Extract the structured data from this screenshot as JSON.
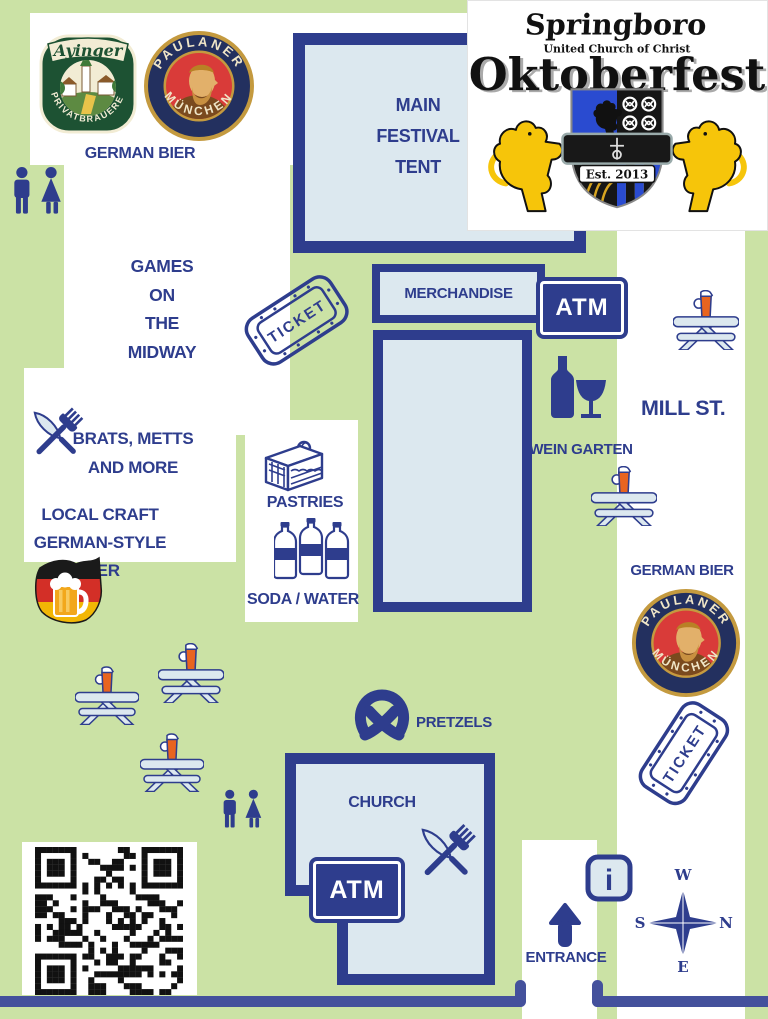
{
  "colors": {
    "navy": "#2e3d8d",
    "green": "#cbe2a5",
    "building_fill": "#dce8ef",
    "road": "#44519c",
    "beer_orange": "#e8641f",
    "lion_gold": "#f6c50a",
    "ayinger_green": "#1d5233",
    "ayinger_cream": "#f2ecd4",
    "paulaner_gold": "#c49a3f",
    "paulaner_navy": "#23305f",
    "paulaner_red": "#d93b39",
    "flag_black": "#1a1a1a",
    "flag_red": "#d32f27",
    "flag_gold": "#f2b705"
  },
  "crest": {
    "line1": "Springboro",
    "line2": "United Church of Christ",
    "line3": "Oktoberfest",
    "est": "Est. 2013"
  },
  "logos": {
    "ayinger": {
      "name": "Ayinger",
      "subtitle": "PRIVATBRAUEREI"
    },
    "paulaner": {
      "name": "PAULANER",
      "city": "MÜNCHEN"
    }
  },
  "labels": {
    "german_bier_top": "GERMAN BIER",
    "main_tent_lines": [
      "MAIN",
      "FESTIVAL",
      "TENT"
    ],
    "games_lines": [
      "GAMES",
      "ON",
      "THE",
      "MIDWAY"
    ],
    "merchandise": "MERCHANDISE",
    "atm": "ATM",
    "ticket": "TICKET",
    "mill_st": "MILL ST.",
    "wein_garten": "WEIN GARTEN",
    "brats_lines": [
      "BRATS, METTS",
      "AND MORE"
    ],
    "local_lines": [
      "LOCAL CRAFT",
      "GERMAN-STYLE BIER"
    ],
    "pastries": "PASTRIES",
    "soda_water": "SODA / WATER",
    "german_bier_right": "GERMAN BIER",
    "pretzels": "PRETZELS",
    "church": "CHURCH",
    "entrance": "ENTRANCE",
    "compass": {
      "top": "W",
      "right": "N",
      "left": "S",
      "bottom": "E"
    }
  },
  "qr_code": {
    "present": true
  }
}
